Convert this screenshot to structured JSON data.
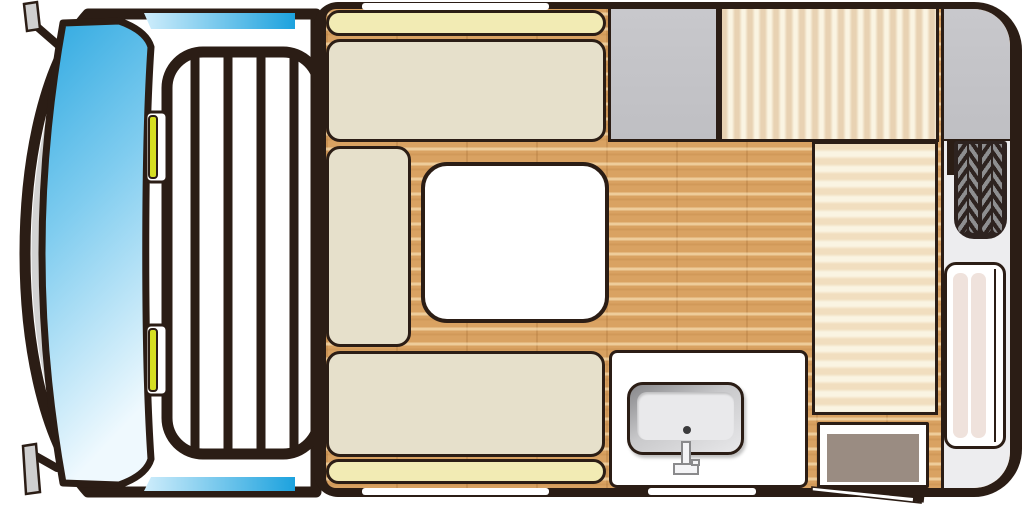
{
  "title": "truck-camper-floorplan-top-view",
  "palette": {
    "outline": "#2B1D15",
    "cushion": "#E6E0CB",
    "backrest": "#F2EBB4",
    "wood": "#D9A262",
    "grayCabinet": "#BFBFC3",
    "mattressTan": "#E8D2B3",
    "mattressTan2": "#F1DEBF",
    "mattressCream": "#FAF4E2",
    "counterWhite": "#FFFFFF",
    "sinkBasin": "#E9E9EB",
    "stepTaupe": "#9A8C82",
    "utilityWhite": "#EDEDEF",
    "tireDark": "#2E2320",
    "tireTread": "#8E8E90",
    "doorStrip": "#EFE2DC",
    "signalYellow": "#D6DF22",
    "mirrorGray": "#CFCFCF",
    "hoodGray": "#D2D2D2",
    "windshieldTop": "#2FA9E1",
    "windshieldMid": "#7FCCEF",
    "windshieldLight": "#EFF9FE",
    "sideWindowLight": "#CFEDFB",
    "sideWindowBlue": "#1CA2DE"
  },
  "cab": {
    "features": [
      "windshield",
      "hood-band",
      "left-mirror-front",
      "left-mirror-rear",
      "side-window-top",
      "side-window-bottom",
      "ladder-rack",
      "rack-bars",
      "marker-light-front",
      "marker-light-rear"
    ]
  },
  "camper": {
    "areas": [
      "backrest-top",
      "bench-top",
      "seat-side",
      "dinette-table",
      "bench-bottom",
      "backrest-bottom",
      "wardrobe-gray",
      "mattress-vertical",
      "wardrobe-gray-right",
      "mattress-horizontal",
      "kitchen-counter",
      "sink",
      "faucet",
      "entry-step",
      "utility-column",
      "spare-tire",
      "entry-door-panel",
      "wall-window-top",
      "wall-window-bottom-left",
      "wall-window-bottom-right",
      "door-swing-line"
    ]
  }
}
